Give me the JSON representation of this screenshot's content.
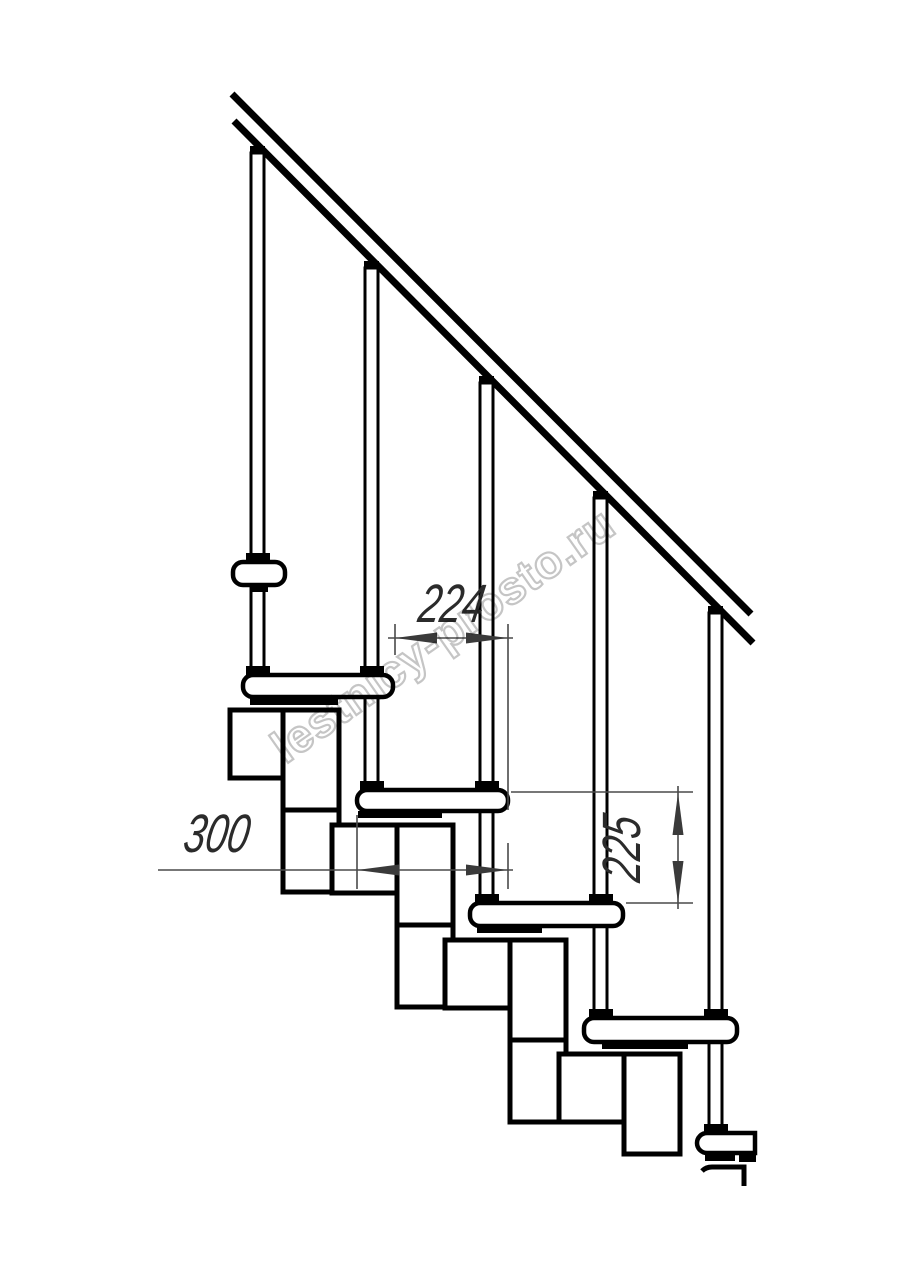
{
  "drawing": {
    "title": "modular staircase side elevation",
    "structure": {
      "handrail_count": 1,
      "baluster_count": 5,
      "tread_count": 6,
      "support_module_count": 4
    }
  },
  "dimensions": {
    "going": {
      "value": "224",
      "orientation": "horizontal"
    },
    "tread_depth": {
      "value": "300",
      "orientation": "horizontal"
    },
    "riser_height": {
      "value": "225",
      "orientation": "vertical"
    }
  },
  "watermark": {
    "text": "lestnicy-prosto.ru",
    "color": "#c5c5c5"
  },
  "colors": {
    "ink": "#000000",
    "background": "#ffffff",
    "dimension_line": "#4a4a4a",
    "dimension_text": "#2b2b2b"
  }
}
